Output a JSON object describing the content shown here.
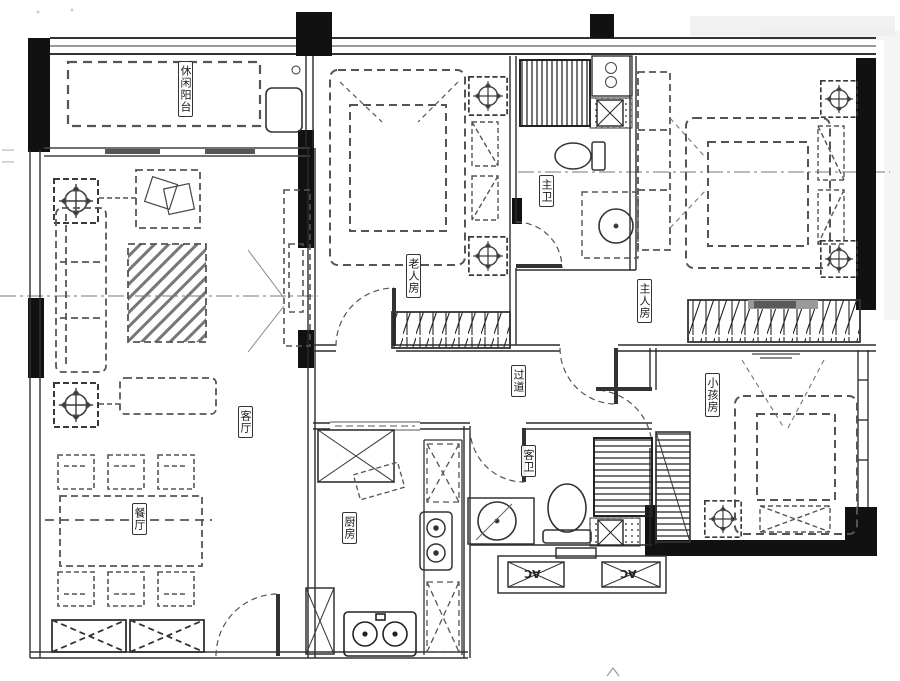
{
  "labels": {
    "balcony": "休闲阳台",
    "living": "客厅",
    "dining": "餐厅",
    "kitchen": "厨房",
    "corridor": "过道",
    "master_bath": "主卫",
    "guest_bath": "客卫",
    "elder_room": "老人房",
    "master_room": "主人房",
    "kids_room": "小孩房",
    "ac_left": "AC",
    "ac_right": "AC"
  },
  "colors": {
    "wall": "#111111",
    "line": "#333333",
    "furniture_dash": "#555555",
    "background": "#ffffff"
  }
}
